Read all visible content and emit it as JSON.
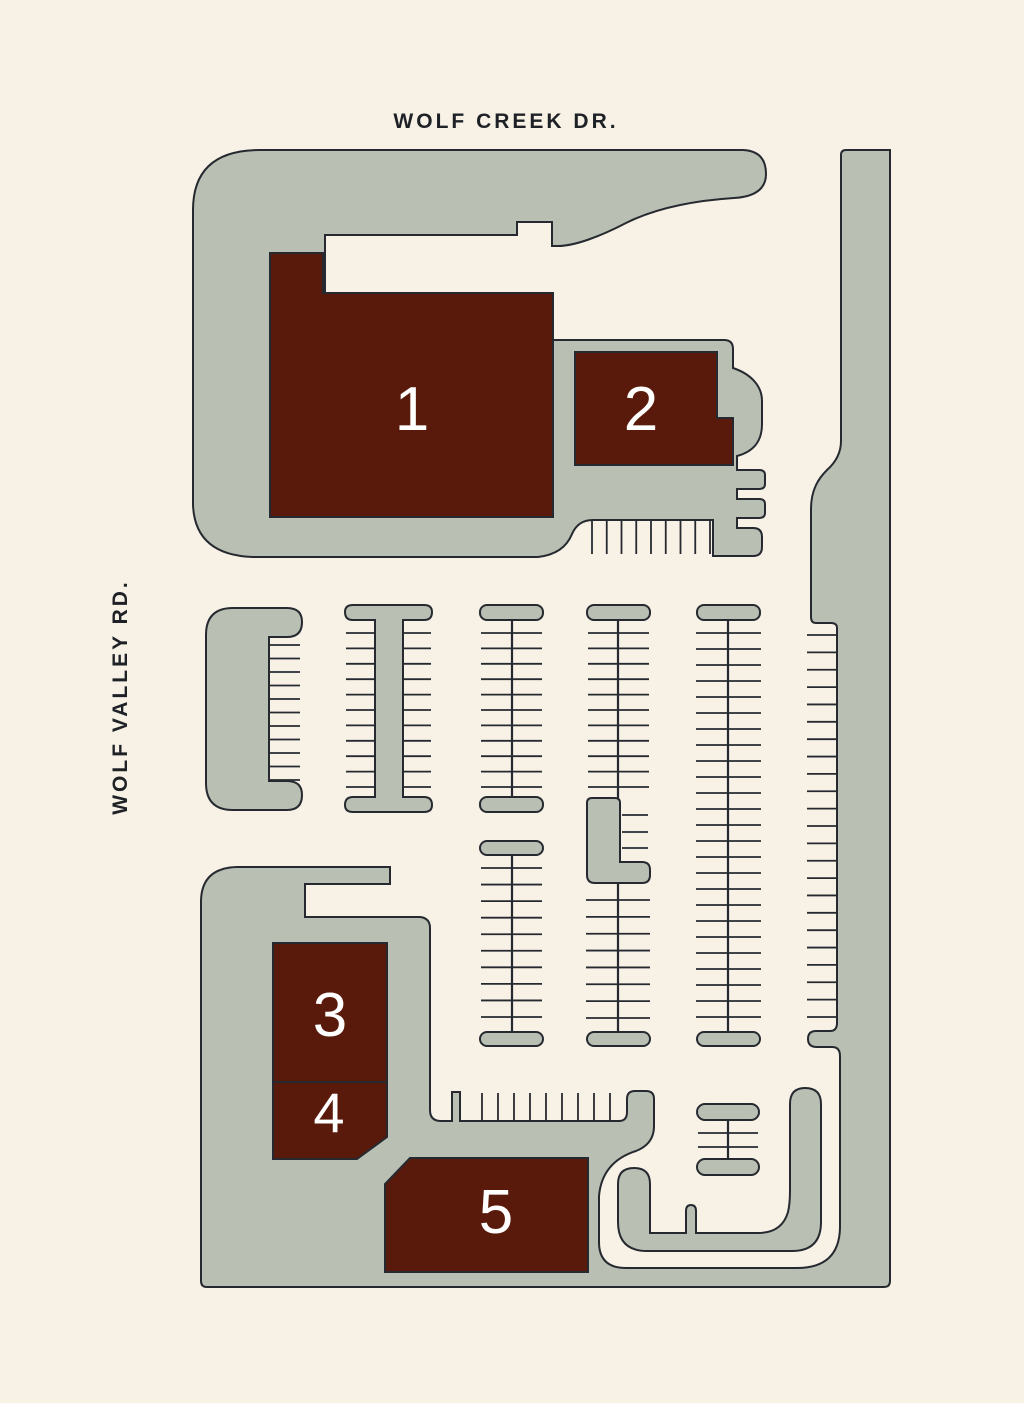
{
  "streets": {
    "top": "WOLF CREEK DR.",
    "left": "WOLF VALLEY RD."
  },
  "buildings": [
    {
      "number": "1"
    },
    {
      "number": "2"
    },
    {
      "number": "3"
    },
    {
      "number": "4"
    },
    {
      "number": "5"
    }
  ],
  "colors": {
    "bg": "#f7f1e6",
    "pavement": "#b9c0b3",
    "building": "#5a1a0b",
    "line": "#262a30",
    "street_text": "#1e2126",
    "number_text": "#ffffff"
  }
}
